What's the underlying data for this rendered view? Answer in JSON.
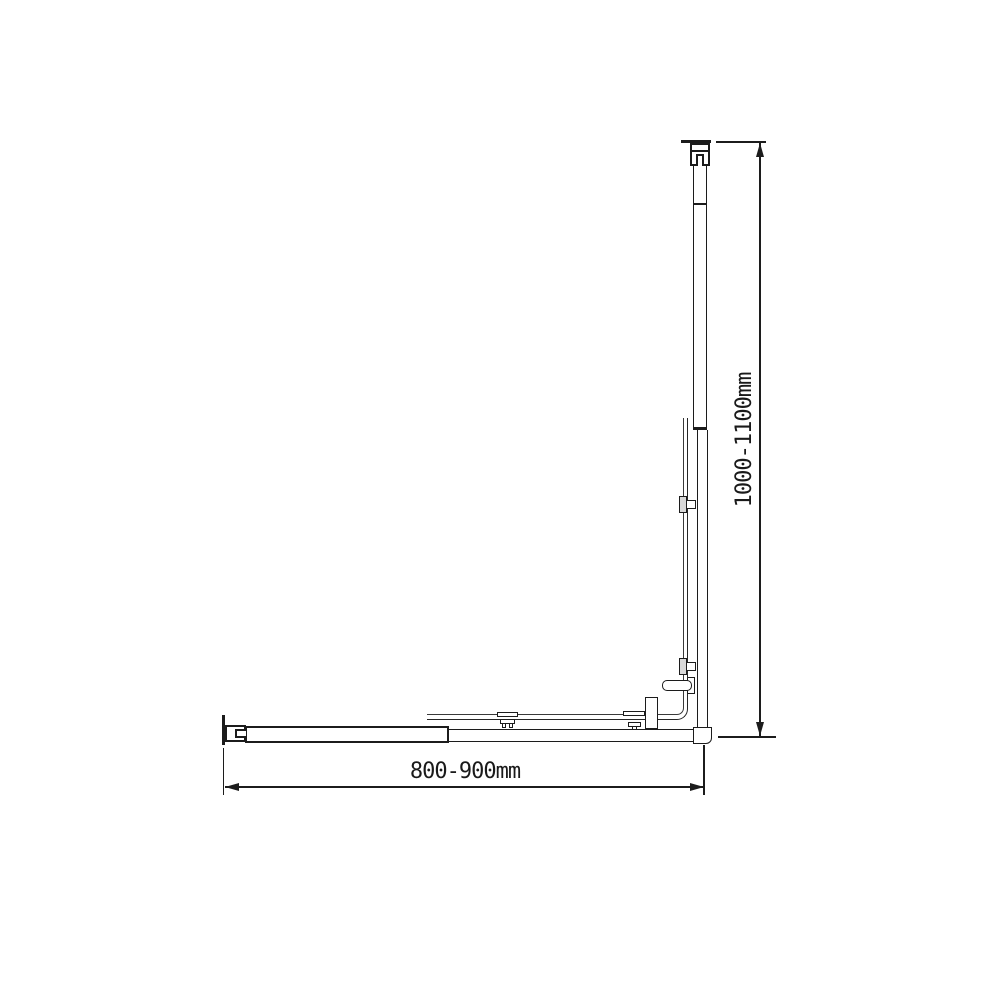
{
  "drawing": {
    "kind": "technical line drawing, adjustable L-shaped corner screen profile",
    "line_color": "#1c1c1c",
    "background": "#ffffff",
    "clamp_fill": "#d8d8d8",
    "dimensions": {
      "horizontal": "800-900mm",
      "vertical": "1000-1100mm"
    }
  }
}
